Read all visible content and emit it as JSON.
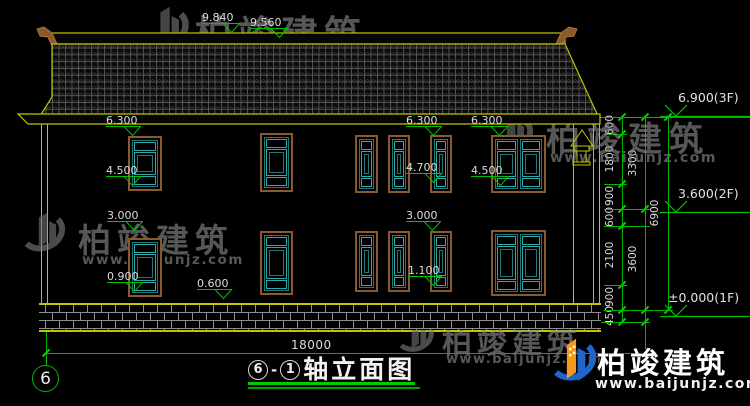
{
  "drawing": {
    "title": "轴立面图",
    "axis_from": "6",
    "axis_to": "1",
    "axis_separator": "-",
    "grid_bubble_left": "6",
    "overall_width_mm": "18000",
    "level_annotations": [
      "9.840",
      "9.560",
      "6.300",
      "6.300",
      "6.300",
      "4.500",
      "4.700",
      "4.500",
      "3.000",
      "3.000",
      "1.100",
      "0.900",
      "0.600"
    ],
    "floor_levels": [
      "6.900(3F)",
      "3.600(2F)",
      "±0.000(1F)"
    ],
    "dim_chain_inner": [
      "600",
      "1800",
      "900",
      "600",
      "2100",
      "900",
      "450"
    ],
    "dim_chain_middle": [
      "3300",
      "3600"
    ],
    "dim_chain_outer": [
      "6900"
    ],
    "windows": [
      {
        "id": "u1",
        "floor": "2F",
        "type": "single"
      },
      {
        "id": "u2",
        "floor": "2F",
        "type": "single"
      },
      {
        "id": "u3",
        "floor": "2F",
        "type": "single"
      },
      {
        "id": "u4",
        "floor": "2F",
        "type": "single"
      },
      {
        "id": "u5",
        "floor": "2F",
        "type": "single"
      },
      {
        "id": "u6",
        "floor": "2F",
        "type": "double"
      },
      {
        "id": "l1",
        "floor": "1F",
        "type": "single"
      },
      {
        "id": "l2",
        "floor": "1F",
        "type": "single"
      },
      {
        "id": "l3",
        "floor": "1F",
        "type": "single"
      },
      {
        "id": "l4",
        "floor": "1F",
        "type": "single"
      },
      {
        "id": "l5",
        "floor": "1F",
        "type": "single"
      },
      {
        "id": "l6",
        "floor": "1F",
        "type": "double"
      }
    ]
  },
  "watermark": {
    "brand": "柏竣建筑",
    "url": "www.baijunjz.com"
  },
  "colors": {
    "linework": "#c3c300",
    "dimension": "#00b400",
    "window_frame": "#8a5a2e",
    "window_lattice": "#2fa8a8",
    "logo_blue": "#1e66cc",
    "logo_orange": "#f5991e"
  }
}
